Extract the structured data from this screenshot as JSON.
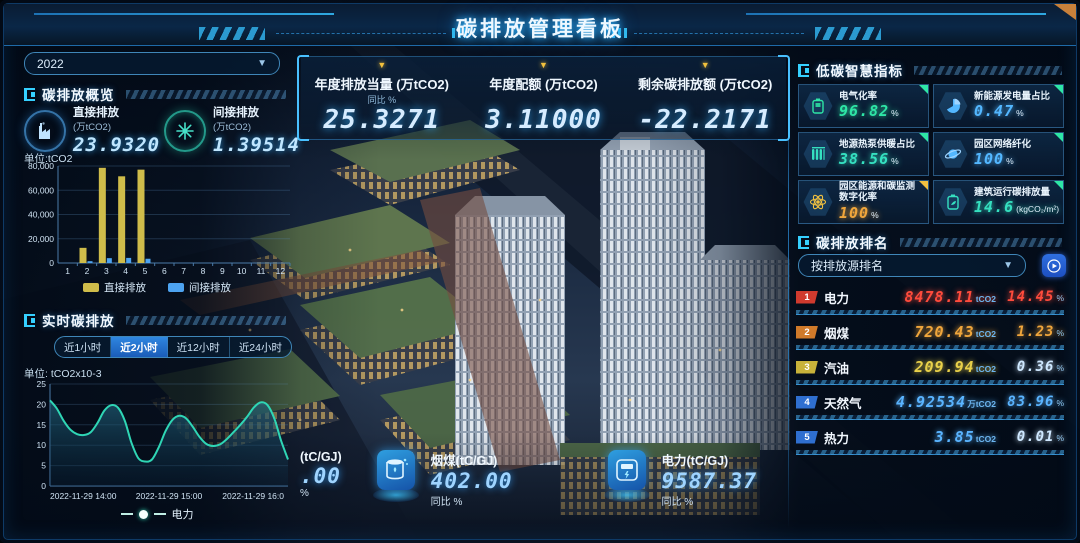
{
  "header": {
    "title": "碳排放管理看板"
  },
  "colors": {
    "accent": "#35d0ff",
    "bar_yellow": "#cfbc4a",
    "bar_blue": "#4da3f0",
    "line_teal": "#2fd6b5",
    "green": "#2ee6a6",
    "blue": "#53b7ff",
    "teal": "#35e0c0",
    "orange": "#f0a63c",
    "red": "#ff4b3c",
    "yellow": "#e8d04a"
  },
  "left": {
    "year": "2022",
    "overview_title": "碳排放概览",
    "overview_stats": [
      {
        "label": "直接排放",
        "unit": "(万tCO2)",
        "value": "23.9320",
        "icon": "factory-icon",
        "ring": "blue"
      },
      {
        "label": "间接排放",
        "unit": "(万tCO2)",
        "value": "1.39514",
        "icon": "turbine-icon",
        "ring": "teal"
      }
    ],
    "bar_unit": "单位:tCO2",
    "realtime_title": "实时碳排放",
    "tabs": [
      "近1小时",
      "近2小时",
      "近12小时",
      "近24小时"
    ],
    "active_tab": 1,
    "line_unit": "单位: tCO2x10-3",
    "line_legend": "电力"
  },
  "center": {
    "kpis": [
      {
        "label": "年度排放当量 (万tCO2)",
        "sub": "同比 %",
        "value": "25.3271"
      },
      {
        "label": "年度配额 (万tCO2)",
        "sub": "",
        "value": "3.11000"
      },
      {
        "label": "剩余碳排放额 (万tCO2)",
        "sub": "",
        "value": "-22.2171"
      }
    ],
    "bottom_kpis": [
      {
        "label": "(tC/GJ)",
        "value": ".00",
        "sub": "%",
        "icon": ""
      },
      {
        "label": "烟煤(tC/GJ)",
        "value": "402.00",
        "sub": "同比 %",
        "icon": "coal-drum-icon"
      },
      {
        "label": "电力(tC/GJ)",
        "value": "9587.37",
        "sub": "同比 %",
        "icon": "power-meter-icon"
      }
    ]
  },
  "right": {
    "smart_title": "低碳智慧指标",
    "metrics": [
      {
        "label": "电气化率",
        "value": "96.82",
        "unit": "%",
        "color": "#2ee6a6",
        "icon": "battery-icon",
        "corner": "#2ee6a6"
      },
      {
        "label": "新能源发电量占比",
        "value": "0.47",
        "unit": "%",
        "color": "#53b7ff",
        "icon": "pie-chart-icon",
        "corner": "#2ee6a6"
      },
      {
        "label": "地源热泵供暖占比",
        "value": "38.56",
        "unit": "%",
        "color": "#35e0c0",
        "icon": "radiator-icon",
        "corner": "#2ee6a6"
      },
      {
        "label": "园区网络纤化",
        "value": "100",
        "unit": "%",
        "color": "#53b7ff",
        "icon": "planet-icon",
        "corner": "#2ee6a6"
      },
      {
        "label": "园区能源和碳监测数字化率",
        "value": "100",
        "unit": "%",
        "color": "#f0a63c",
        "icon": "atom-icon",
        "corner": "#f0c040"
      },
      {
        "label": "建筑运行碳排放量",
        "value": "14.6",
        "unit": "(kgCO₂/m²)",
        "color": "#35e0c0",
        "icon": "battery-leaf-icon",
        "corner": "#2ee6a6"
      }
    ],
    "ranking_title": "碳排放排名",
    "ranking_select": "按排放源排名",
    "ranking": [
      {
        "rank": "1",
        "name": "电力",
        "value": "8478.11",
        "unit": "tCO2",
        "pct": "14.45",
        "value_color": "#ff4b3c",
        "pct_color": "#ff4b3c",
        "badge": "#d03a2e"
      },
      {
        "rank": "2",
        "name": "烟煤",
        "value": "720.43",
        "unit": "tCO2",
        "pct": "1.23",
        "value_color": "#f0a63c",
        "pct_color": "#f0a63c",
        "badge": "#d07a2a"
      },
      {
        "rank": "3",
        "name": "汽油",
        "value": "209.94",
        "unit": "tCO2",
        "pct": "0.36",
        "value_color": "#e8d04a",
        "pct_color": "#cfe8ff",
        "badge": "#c8b23a"
      },
      {
        "rank": "4",
        "name": "天然气",
        "value": "4.92534",
        "unit": "万tCO2",
        "pct": "83.96",
        "value_color": "#5ab4ff",
        "pct_color": "#5ab4ff",
        "badge": "#2f6fd0"
      },
      {
        "rank": "5",
        "name": "热力",
        "value": "3.85",
        "unit": "tCO2",
        "pct": "0.01",
        "value_color": "#5ab4ff",
        "pct_color": "#cfe8ff",
        "badge": "#2f6fd0"
      }
    ]
  },
  "chart_data": [
    {
      "type": "bar",
      "title": "碳排放概览（月度直接/间接排放）",
      "unit_label": "单位:tCO2",
      "categories": [
        "1",
        "2",
        "3",
        "4",
        "5",
        "6",
        "7",
        "8",
        "9",
        "10",
        "11",
        "12"
      ],
      "series": [
        {
          "name": "直接排放",
          "color": "#cfbc4a",
          "values": [
            0,
            12500,
            78500,
            71500,
            77000,
            0,
            0,
            0,
            0,
            0,
            0,
            0
          ]
        },
        {
          "name": "间接排放",
          "color": "#4da3f0",
          "values": [
            0,
            1500,
            4000,
            4200,
            3500,
            0,
            0,
            0,
            0,
            0,
            0,
            0
          ]
        }
      ],
      "ylim": [
        0,
        80000
      ],
      "yticks": [
        0,
        20000,
        40000,
        60000,
        80000
      ],
      "ytick_labels": [
        "0",
        "20,000",
        "40,000",
        "60,000",
        "80,000"
      ],
      "legend_position": "bottom",
      "grid": true
    },
    {
      "type": "line",
      "title": "实时碳排放",
      "unit_label": "单位: tCO2x10-3",
      "series": [
        {
          "name": "电力",
          "color": "#2fd6b5",
          "area": true,
          "values": [
            21,
            19,
            16,
            13.8,
            12.7,
            12.5,
            13.2,
            15.5,
            18.5,
            19.8,
            19.2,
            16,
            10.5,
            6.8,
            6.0,
            6.5,
            9.5,
            13.5,
            16.2,
            17.2,
            16.6,
            14.5,
            12,
            10.3,
            9.8,
            10.2,
            11.5,
            13.2,
            15,
            17,
            19.3,
            20.5,
            19.8,
            16.5,
            11,
            6.5
          ]
        }
      ],
      "x_tick_labels": [
        "2022-11-29 14:00",
        "2022-11-29 15:00",
        "2022-11-29 16:0"
      ],
      "ylim": [
        0,
        25
      ],
      "yticks": [
        0,
        5,
        10,
        15,
        20,
        25
      ],
      "legend_position": "bottom",
      "grid": true
    }
  ]
}
